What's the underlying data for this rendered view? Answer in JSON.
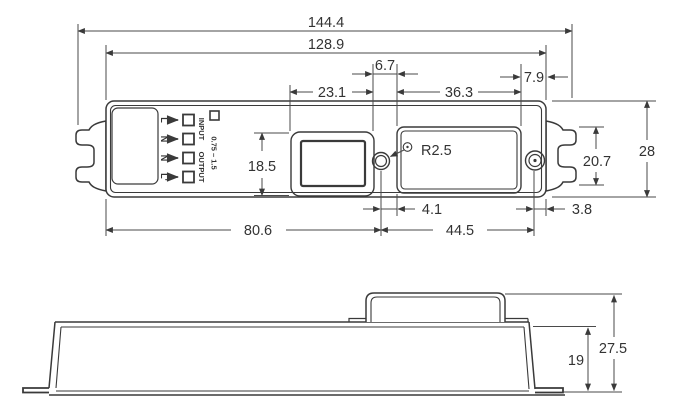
{
  "drawing_type": "mechanical dimension drawing",
  "top_view": {
    "dims": {
      "overall_length": "144.4",
      "body_length": "128.9",
      "opening_to_panel_gap": "6.7",
      "panel_to_edge": "7.9",
      "opening_width": "23.1",
      "panel_width": "36.3",
      "opening_height": "18.5",
      "body_width": "28",
      "clip_width": "20.7",
      "hole_radius": "R2.5",
      "left_to_hole": "80.6",
      "hole_to_panel": "4.1",
      "hole_to_screw": "44.5",
      "screw_to_edge": "3.8"
    },
    "marking": {
      "terminals": [
        "L",
        "N",
        "N",
        "L'"
      ],
      "input": "INPUT",
      "output": "OUTPUT",
      "wire_range": "0.75 – 1.5"
    }
  },
  "side_view": {
    "dims": {
      "body_height": "19",
      "overall_height": "27.5"
    }
  },
  "colors": {
    "line": "#3a3a3a",
    "background": "#ffffff"
  }
}
